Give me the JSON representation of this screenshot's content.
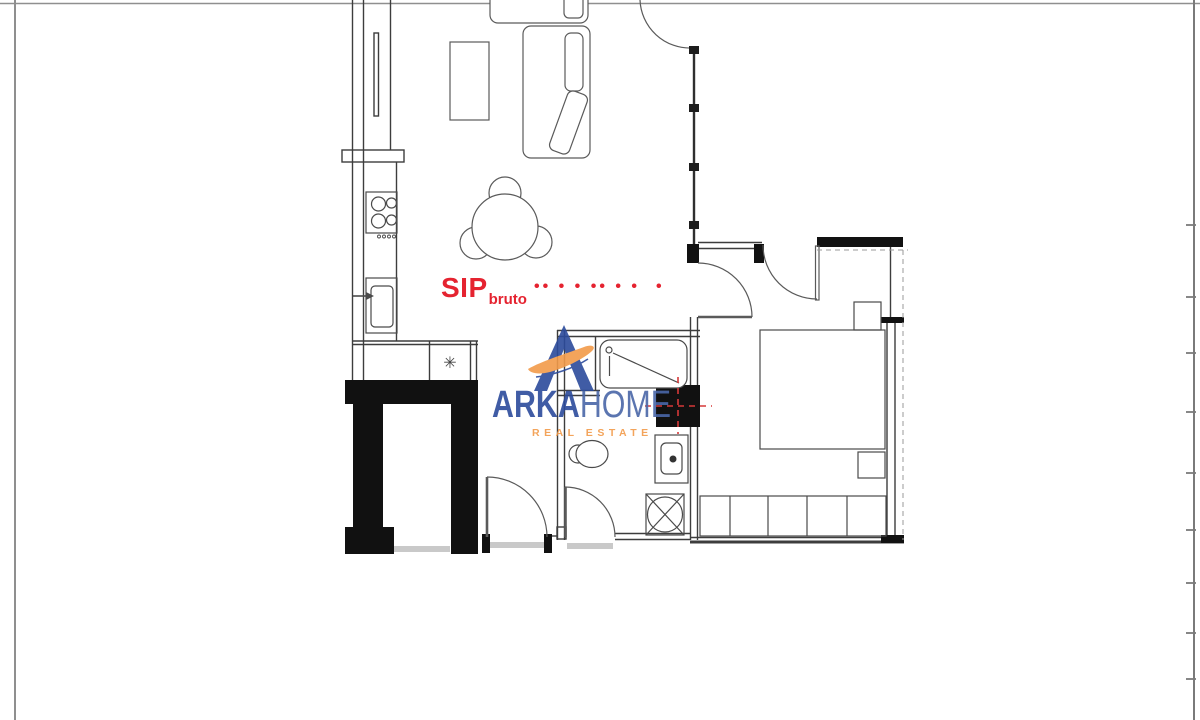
{
  "page": {
    "background": "#ffffff",
    "border_color": "#8f8f8f"
  },
  "plan": {
    "area_label": {
      "main": "SIP",
      "subscript": "bruto",
      "dots": "•• • • •• • •",
      "trailing_dot": "•",
      "color": "#e52330"
    },
    "symbols": {
      "boiler_asterisk": "✳"
    },
    "line_color": "#4a4a4a",
    "wall_color": "#1a1a1a",
    "highlight_red": "#d63939"
  },
  "watermark": {
    "brand_bold": "ARKA",
    "brand_light": "HOME",
    "tagline": "REAL ESTATE",
    "blue": "#2c4b9c",
    "home_blue": "#4a67a8",
    "orange": "#f29b4a"
  }
}
